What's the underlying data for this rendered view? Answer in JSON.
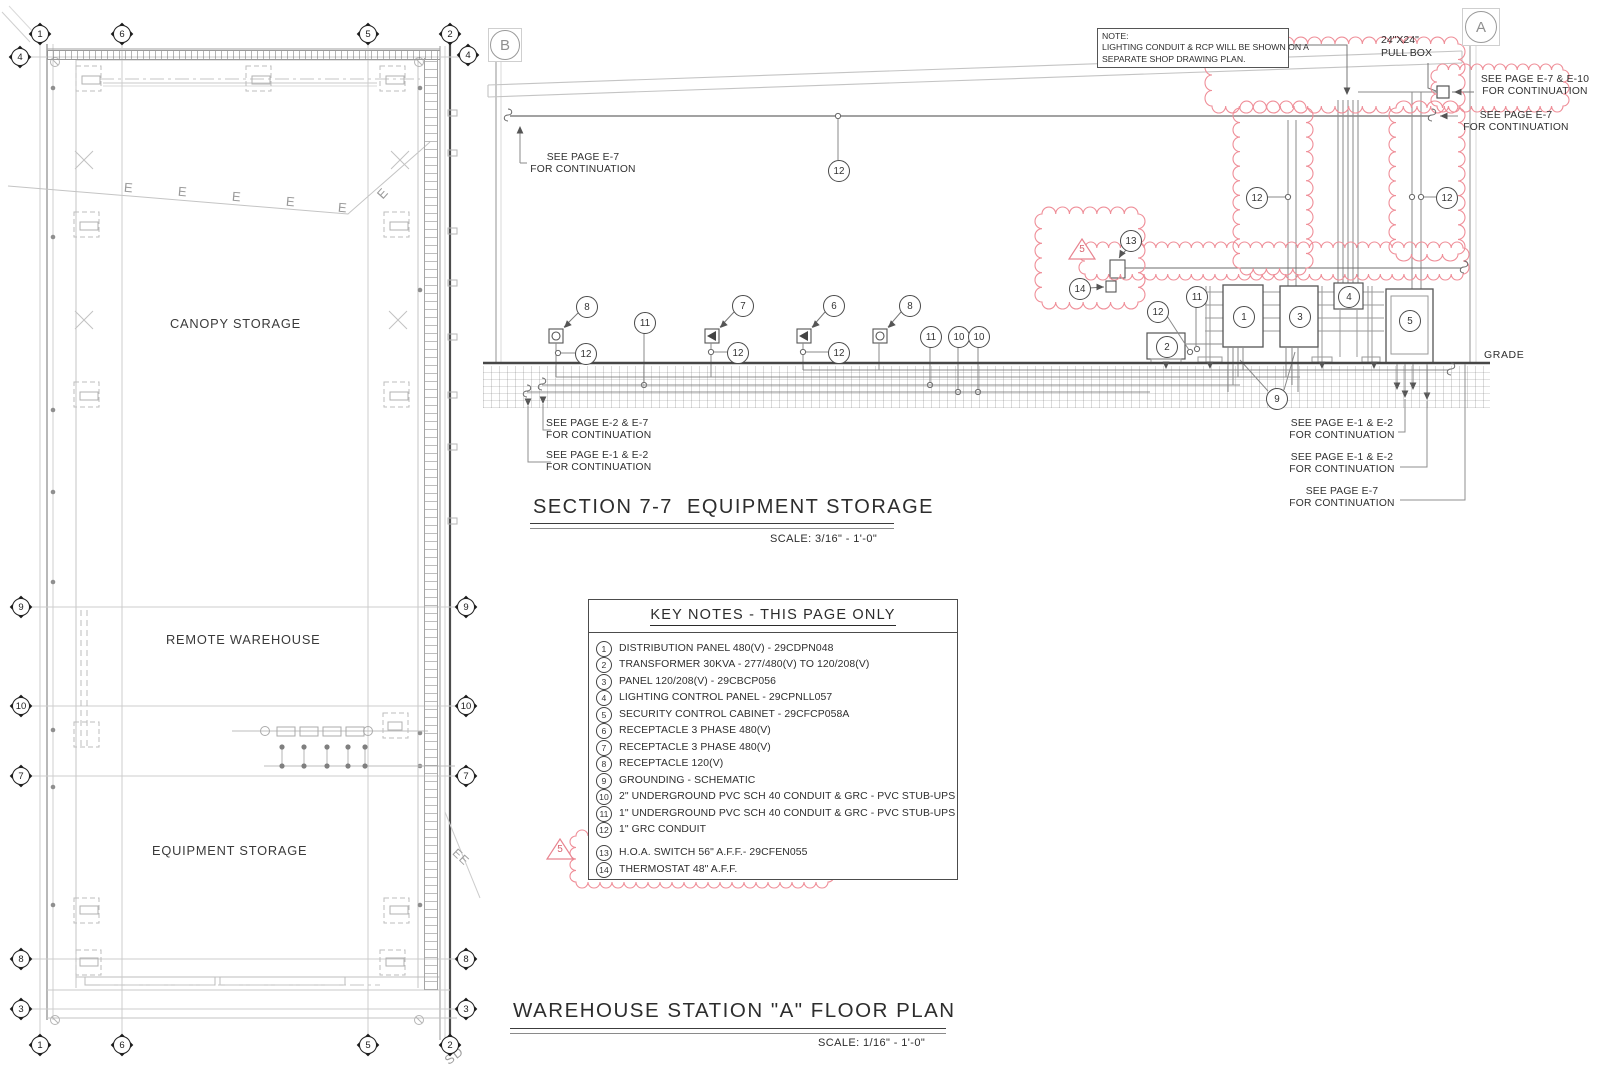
{
  "sheet": {
    "section_title": "SECTION 7-7  EQUIPMENT STORAGE",
    "section_scale": "SCALE: 3/16\" - 1'-0\"",
    "plan_title": "WAREHOUSE STATION \"A\" FLOOR PLAN",
    "plan_scale": "SCALE: 1/16\" - 1'-0\""
  },
  "section": {
    "marker_b": "B",
    "marker_a": "A",
    "note_lines": [
      "NOTE:",
      "LIGHTING CONDUIT & RCP WILL BE SHOWN ON A",
      "SEPARATE SHOP DRAWING PLAN."
    ],
    "pull_box": [
      "24\"X24\"",
      "PULL BOX"
    ],
    "grade": "GRADE",
    "labels": {
      "e7_e10": [
        "SEE PAGE E-7 & E-10",
        "FOR CONTINUATION"
      ],
      "e7": [
        "SEE PAGE E-7",
        "FOR CONTINUATION"
      ],
      "e2_e7": [
        "SEE PAGE E-2 & E-7",
        "FOR CONTINUATION"
      ],
      "e1_e2": [
        "SEE PAGE E-1 & E-2",
        "FOR CONTINUATION"
      ]
    }
  },
  "tags": {
    "n1": "1",
    "n2": "2",
    "n3": "3",
    "n4": "4",
    "n5": "5",
    "n6": "6",
    "n7": "7",
    "n8": "8",
    "n9": "9",
    "n10": "10",
    "n11": "11",
    "n12": "12",
    "n13": "13",
    "n14": "14",
    "rev": "5"
  },
  "key_notes": {
    "title": "KEY NOTES - THIS PAGE ONLY",
    "items": [
      {
        "n": "1",
        "t": "DISTRIBUTION PANEL 480(V) - 29CDPN048"
      },
      {
        "n": "2",
        "t": "TRANSFORMER 30KVA - 277/480(V) TO 120/208(V)"
      },
      {
        "n": "3",
        "t": "PANEL 120/208(V) - 29CBCP056"
      },
      {
        "n": "4",
        "t": "LIGHTING CONTROL PANEL - 29CPNLL057"
      },
      {
        "n": "5",
        "t": "SECURITY CONTROL CABINET - 29CFCP058A"
      },
      {
        "n": "6",
        "t": "RECEPTACLE 3 PHASE 480(V)"
      },
      {
        "n": "7",
        "t": "RECEPTACLE 3 PHASE 480(V)"
      },
      {
        "n": "8",
        "t": "RECEPTACLE 120(V)"
      },
      {
        "n": "9",
        "t": "GROUNDING - SCHEMATIC"
      },
      {
        "n": "10",
        "t": "2\" UNDERGROUND PVC SCH 40 CONDUIT & GRC - PVC STUB-UPS"
      },
      {
        "n": "11",
        "t": "1\" UNDERGROUND PVC SCH 40 CONDUIT & GRC - PVC STUB-UPS"
      },
      {
        "n": "12",
        "t": "1\"  GRC CONDUIT"
      },
      {
        "n": "13",
        "t": "H.O.A. SWITCH 56\" A.F.F.- 29CFEN055"
      },
      {
        "n": "14",
        "t": "THERMOSTAT 48\" A.F.F."
      }
    ]
  },
  "plan": {
    "rooms": {
      "canopy": "CANOPY STORAGE",
      "remote": "REMOTE WAREHOUSE",
      "equipment": "EQUIPMENT STORAGE"
    },
    "grid": {
      "g1": "1",
      "g2": "2",
      "g3": "3",
      "g4": "4",
      "g5": "5",
      "g6": "6",
      "g7": "7",
      "g8": "8",
      "g9": "9",
      "g10": "10"
    },
    "e": "E",
    "ee": "EE",
    "sd": "SD"
  }
}
